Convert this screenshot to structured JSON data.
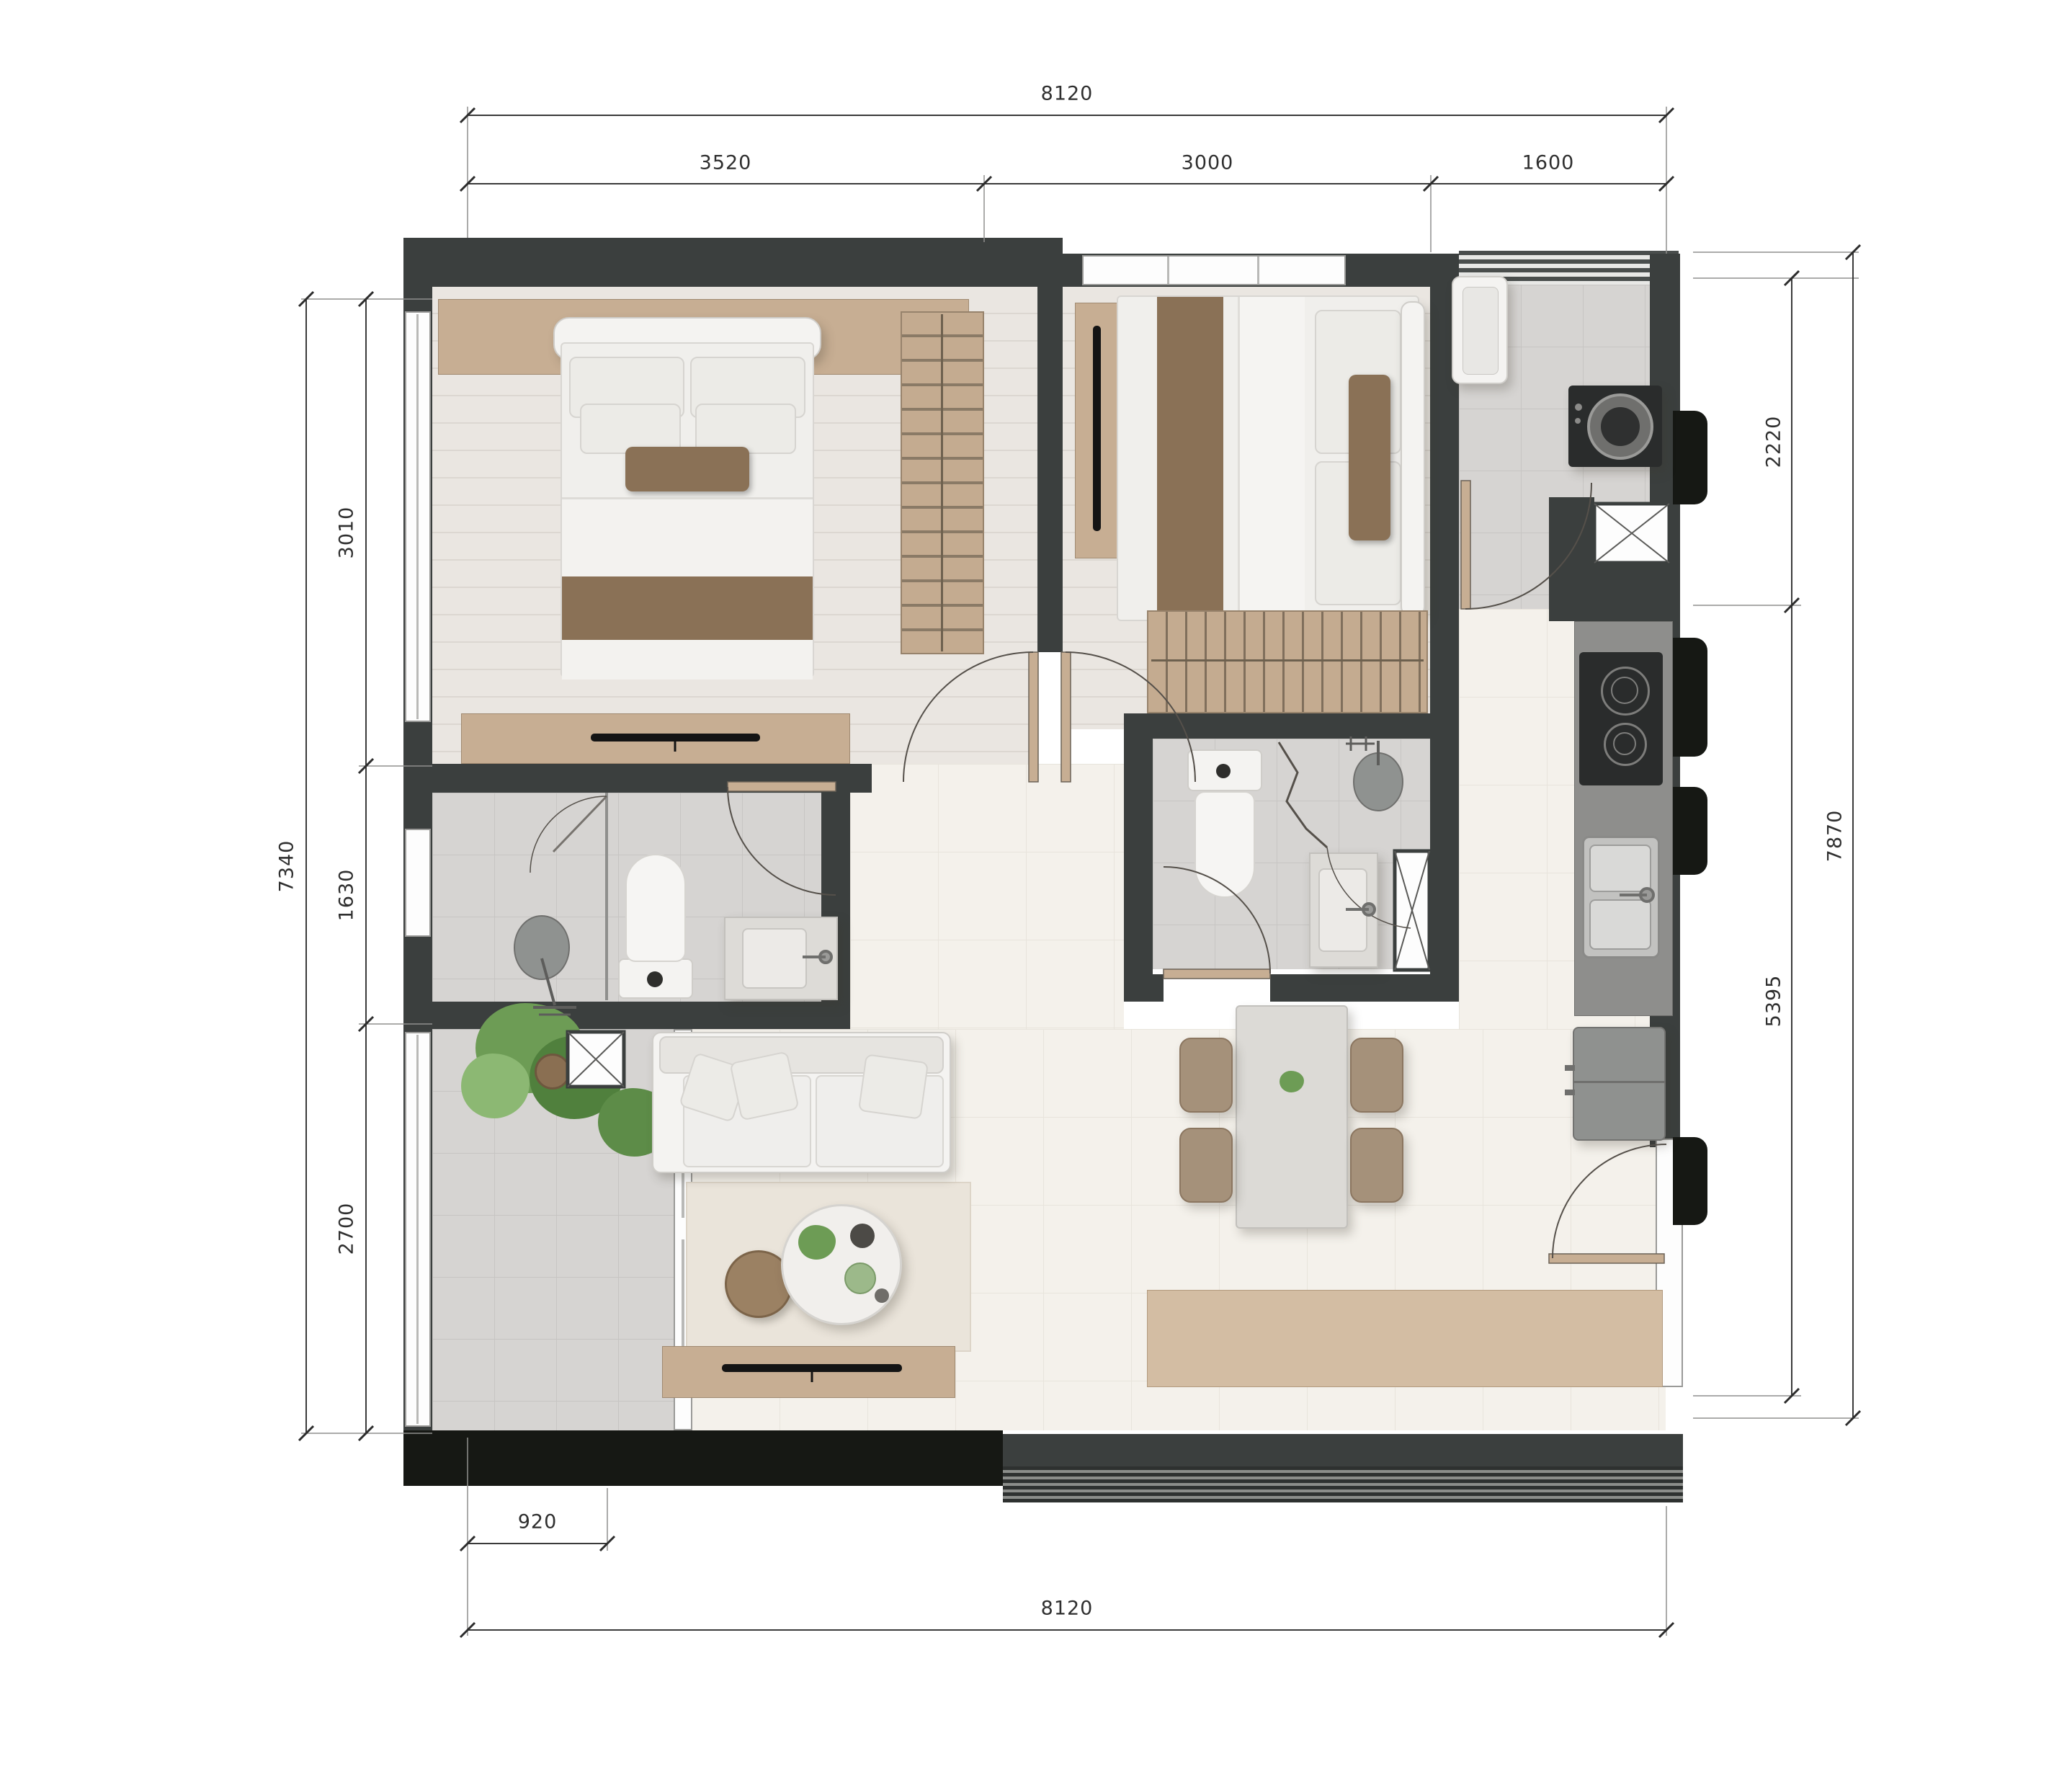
{
  "drawing": {
    "type": "apartment-floor-plan-top-view",
    "units": "mm"
  },
  "dimensions": {
    "top": {
      "total": "8120",
      "segments": [
        "3520",
        "3000",
        "1600"
      ]
    },
    "left": {
      "total": "7340",
      "segments": [
        "3010",
        "1630",
        "2700"
      ]
    },
    "right": {
      "total": "7870",
      "segments": [
        "2220",
        "5395"
      ]
    },
    "bottom": {
      "offset": "920",
      "total": "8120"
    }
  },
  "colors": {
    "wall": "#3b3f3e",
    "wall_dark_band": "#161814",
    "wood_furniture": "#c7ae93",
    "accent_textile_brown": "#8a7156",
    "tile_floor": "#d6d4d2",
    "living_floor": "#f4f1eb",
    "bedroom_floor": "#eae6e1",
    "counter": "#8e8e8c",
    "appliance_black": "#2a2c2c",
    "plant_green": "#6d9c55",
    "dimension_text": "#2f2f2f"
  }
}
